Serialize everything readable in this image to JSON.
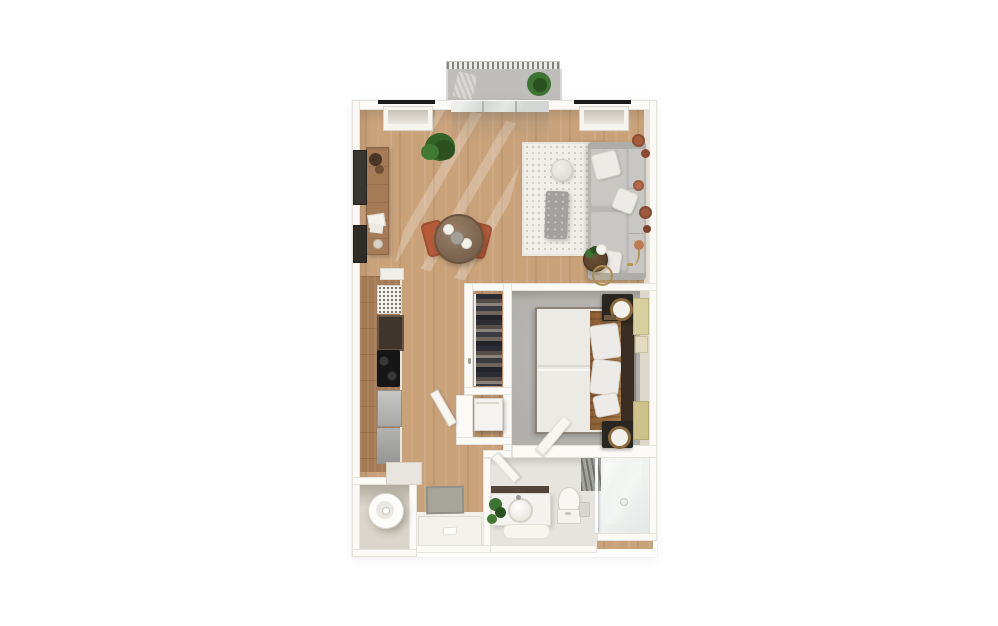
{
  "meta": {
    "kind": "3d-rendered-floor-plan",
    "view": "top-down",
    "unit": "one-bedroom-apartment"
  },
  "palette": {
    "bg": "#ffffff",
    "wall": "#fbfaf7",
    "wallEdge": "#e3dfd7",
    "wood": "#c9a27a",
    "woodDark": "#b6906a",
    "woodCabinet": "#a47b55",
    "carpet": "#b2b0ac",
    "bathFloor": "#e6e4df",
    "shower": "#eef0ee",
    "laundryFloor": "#dbd6cb",
    "balconyFloor": "#bfbebb",
    "entryTile": "#f2f0ea",
    "rug": "#f0eee8",
    "rugDot": "#c7c3b9",
    "sofa": "#b7b6b3",
    "cushion": "#c8c7c4",
    "pillow": "#edebe7",
    "terracotta": "#b55a3a",
    "plant": "#3c7431",
    "plantDark": "#28511f",
    "dark": "#292521",
    "steel": "#b5b6b4",
    "black": "#1b1b1b",
    "glass": "#d3d6d3",
    "headboard": "#3a2d21",
    "blanket": "#96683c",
    "artYellow": "#d9d0a2",
    "clay": "#a55c3d",
    "mat": "#a7a49b"
  },
  "rooms": [
    {
      "name": "balcony",
      "floor": "concrete-gray",
      "items": [
        "railing",
        "lounge-chair",
        "potted-plant"
      ]
    },
    {
      "name": "living-dining",
      "floor": "wood",
      "items": [
        "sofa",
        "area-rug",
        "pouf",
        "ottoman",
        "nesting-side-tables",
        "floor-lamp",
        "wall-plates",
        "console-table",
        "wall-art",
        "potted-plant",
        "dining-table",
        "dining-chairs"
      ]
    },
    {
      "name": "kitchen",
      "floor": "wood",
      "items": [
        "cabinet-run",
        "dish-rack",
        "sink-module",
        "cooktop",
        "oven",
        "refrigerator",
        "end-counter"
      ]
    },
    {
      "name": "walk-in-closet",
      "floor": "wood",
      "items": [
        "hanging-clothes",
        "closet-door"
      ]
    },
    {
      "name": "utility-closet",
      "floor": "wood",
      "items": [
        "stacked-appliance"
      ]
    },
    {
      "name": "bedroom",
      "floor": "carpet",
      "items": [
        "bed",
        "headboard",
        "nightstand-upper",
        "nightstand-lower",
        "table-lamps",
        "leaning-artwork",
        "door"
      ]
    },
    {
      "name": "bathroom",
      "floor": "tile",
      "items": [
        "vanity",
        "round-sink",
        "plant",
        "bath-mat",
        "toilet",
        "towel",
        "glass-shower",
        "tiled-wall"
      ]
    },
    {
      "name": "laundry-closet",
      "floor": "tile",
      "items": [
        "washer"
      ]
    },
    {
      "name": "entry-hall",
      "floor": "wood-and-tile",
      "items": [
        "doormat",
        "entry-platform",
        "interior-door"
      ]
    }
  ],
  "architecture": [
    "exterior-walls",
    "two-windows-top-wall",
    "sliding-balcony-door",
    "interior-partitions"
  ]
}
